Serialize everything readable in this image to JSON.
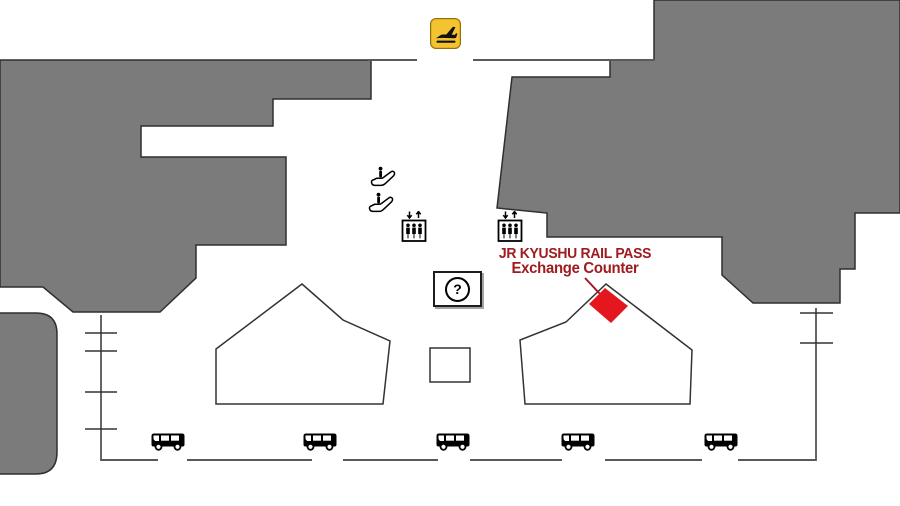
{
  "map": {
    "label": {
      "line1": "JR KYUSHU RAIL PASS",
      "line2": "Exchange Counter"
    },
    "info_symbol": "?",
    "colors": {
      "building_gray": "#7b7b7b",
      "marker_red": "#e5171e",
      "label_red": "#9e1b20",
      "sign_yellow": "#f3c42f",
      "outline_dark": "#2f2f2f",
      "road_gray": "#5a5a5a"
    },
    "icons": {
      "arrivals_sign": "airplane-arrivals",
      "escalator": "escalator",
      "elevator": "elevator",
      "information": "information-counter",
      "bus": "bus",
      "marker": "exchange-counter-diamond"
    },
    "bus_count": 5
  }
}
